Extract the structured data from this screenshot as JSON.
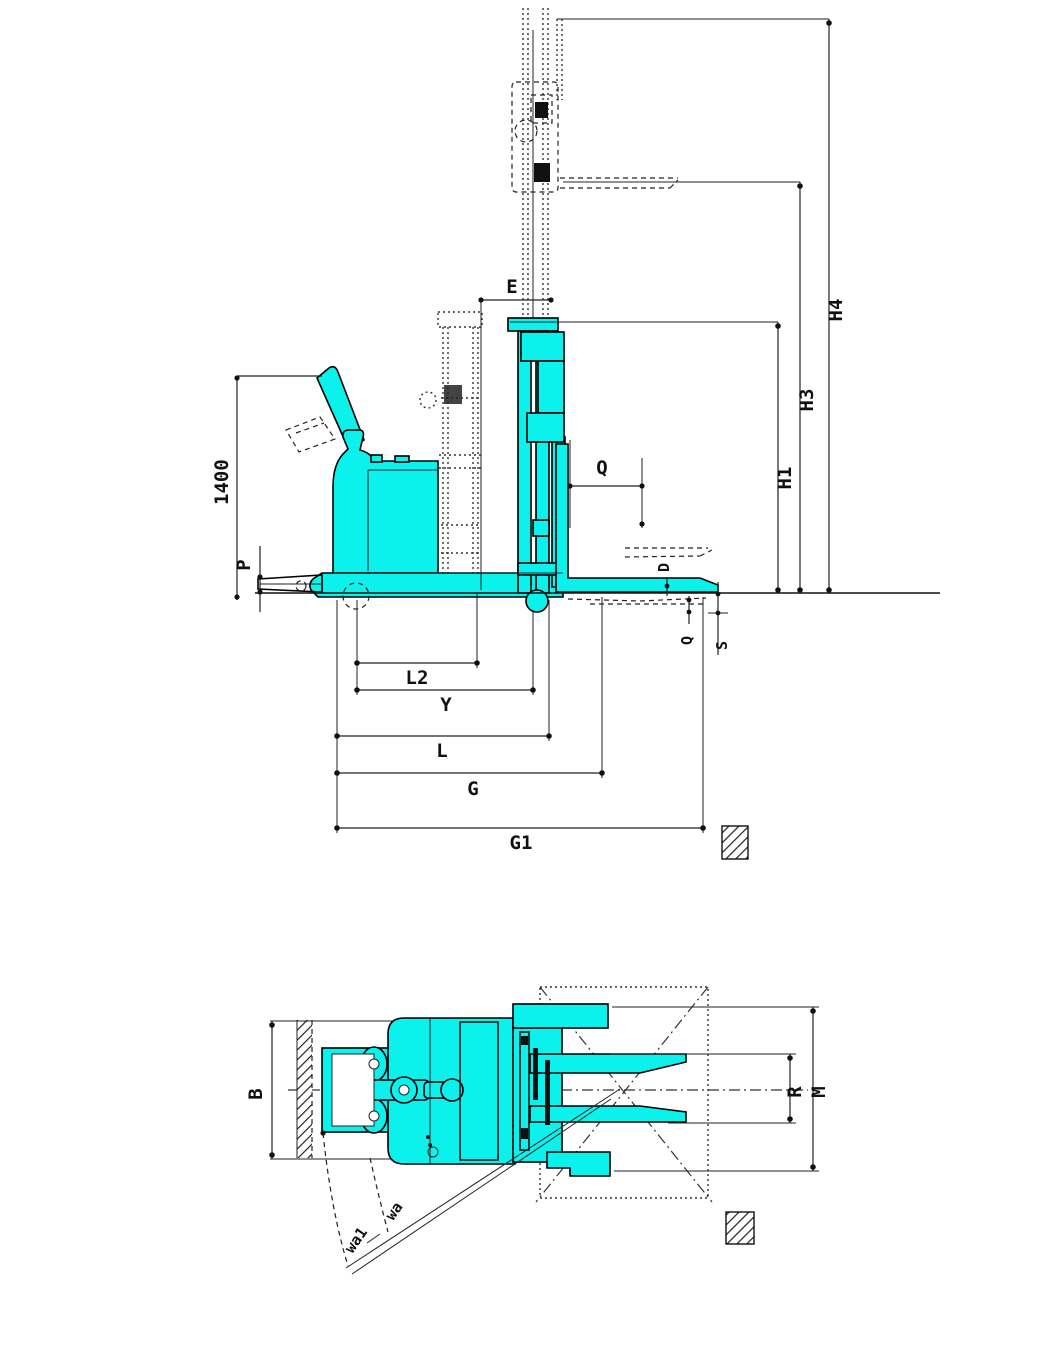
{
  "figure": {
    "type": "technical-dimension-drawing",
    "subject": "electric reach stacker forklift, side elevation and plan view",
    "colors": {
      "machine_fill": "#0BF1EB",
      "line": "#111111",
      "background": "#FFFFFF"
    },
    "side_view": {
      "dimensions": {
        "tiller_height": "1400",
        "p": "P",
        "e": "E",
        "q_load": "Q",
        "h1": "H1",
        "h3": "H3",
        "h4": "H4",
        "d_fork": "D",
        "q_fork": "Q",
        "s_fork": "S",
        "l2": "L2",
        "y": "Y",
        "l": "L",
        "g": "G",
        "g1": "G1"
      }
    },
    "top_view": {
      "dimensions": {
        "b": "B",
        "r": "R",
        "m": "M",
        "wa": "wa",
        "wa1": "wa1"
      }
    }
  }
}
